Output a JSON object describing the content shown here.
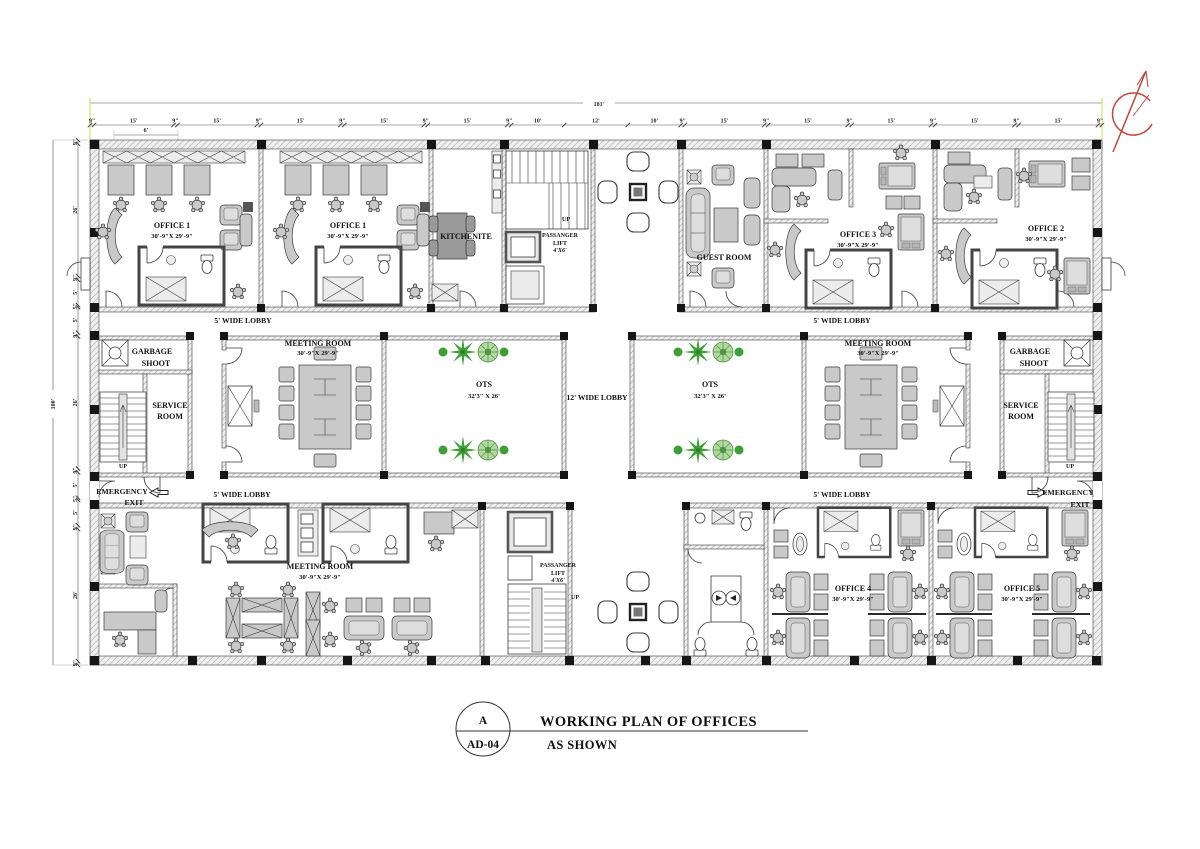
{
  "drawing": {
    "rooms": {
      "office_1a": {
        "name": "OFFICE 1",
        "size": "30'-9\"X 29'-9\""
      },
      "office_1b": {
        "name": "OFFICE 1",
        "size": "30'-9\"X 29'-9\""
      },
      "kitchenette": {
        "name": "KITCHENITE"
      },
      "guest_room": {
        "name": "GUEST ROOM"
      },
      "office_3": {
        "name": "OFFICE 3",
        "size": "30'-9\"X 29'-9\""
      },
      "office_2": {
        "name": "OFFICE 2",
        "size": "30'-9\"X 29'-9\""
      },
      "meeting_mid_left": {
        "name": "MEETING ROOM",
        "size": "30'-9\"X 29'-9\""
      },
      "meeting_mid_right": {
        "name": "MEETING ROOM",
        "size": "30'-9\"X 29'-9\""
      },
      "meeting_bottom": {
        "name": "MEETING ROOM",
        "size": "30'-9\"X 29'-9\""
      },
      "ots_left": {
        "name": "OTS",
        "size": "32'3\" X 26'"
      },
      "ots_right": {
        "name": "OTS",
        "size": "32'3\" X 26'"
      },
      "office_4": {
        "name": "OFFICE 4",
        "size": "30'-9\"X 29'-9\""
      },
      "office_5": {
        "name": "OFFICE 5",
        "size": "30'-9\"X 29'-9\""
      },
      "garbage_left": {
        "l1": "GARBAGE",
        "l2": "SHOOT"
      },
      "garbage_right": {
        "l1": "GARBAGE",
        "l2": "SHOOT"
      },
      "service_left": {
        "l1": "SERVICE",
        "l2": "ROOM"
      },
      "service_right": {
        "l1": "SERVICE",
        "l2": "ROOM"
      }
    },
    "lifts": {
      "top": {
        "l1": "PASSANGER",
        "l2": "LIFT",
        "l3": "4'X6'"
      },
      "bottom": {
        "l1": "PASSANGER",
        "l2": "LIFT",
        "l3": "4'X6'"
      }
    },
    "stairs": {
      "up_top": "UP",
      "up_bottom": "UP",
      "up_service_left": "UP",
      "up_service_right": "UP"
    },
    "lobbies": {
      "top_left": "5' WIDE LOBBY",
      "top_right": "5' WIDE LOBBY",
      "bottom_left": "5' WIDE LOBBY",
      "bottom_right": "5' WIDE LOBBY",
      "central": "12' WIDE LOBBY"
    },
    "exits": {
      "left": {
        "l1": "EMERGENCY",
        "l2": "EXIT"
      },
      "right": {
        "l1": "EMERGENCY",
        "l2": "EXIT"
      }
    },
    "dimensions": {
      "total_width": "181'",
      "total_height": "100'",
      "shelf_depth": "6'",
      "top_chain": [
        "9\"",
        "15'",
        "9\"",
        "15'",
        "9\"",
        "15'",
        "9\"",
        "15'",
        "9\"",
        "15'",
        "9\"",
        "10'",
        "12'",
        "10'",
        "9\"",
        "15'",
        "9\"",
        "15'",
        "9\"",
        "15'",
        "9\"",
        "15'",
        "9\"",
        "15'",
        "9\""
      ],
      "left_chain": [
        "9\"",
        "26'",
        "9\"",
        "5'",
        "5\"",
        "5'",
        "9\"",
        "26'",
        "9\"",
        "5'",
        "5\"",
        "5'",
        "9\"",
        "26'",
        "9\""
      ]
    },
    "title_block": {
      "detail_letter": "A",
      "sheet_number": "AD-04",
      "title": "WORKING PLAN OF OFFICES",
      "scale_note": "AS SHOWN"
    },
    "colors": {
      "plant_green": "#3f9e35",
      "tree_green": "#b2d8a0",
      "north_arrow_red": "#c2473b",
      "wall_fill": "#efefef",
      "furniture_gray": "#c9c9c9",
      "line": "#333333",
      "extension_yellow": "#d6dc55"
    }
  }
}
